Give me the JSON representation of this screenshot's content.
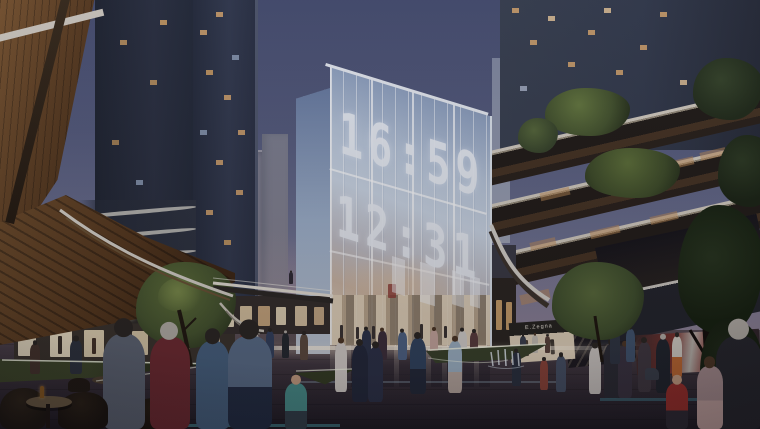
{
  "scene": {
    "title": "Dusk architectural rendering of a retail plaza with a glass clock building",
    "clock": {
      "row1": "16:59",
      "row2": "12:31"
    },
    "signs": {
      "swarovski": "Swarovski",
      "zegna": "E.Zegna",
      "givenchy": "Givenchy"
    },
    "palette": {
      "sky_top": "#464d6e",
      "sky_mid": "#6d7190",
      "horizon_pink": "#b99ba3",
      "glass_blue": "#aebfd6",
      "wood_brown": "#64452b",
      "plaza_dark": "#322b34",
      "digit_white": "#edf1f7",
      "tree_green": "#56663a",
      "window_warm": "#d9a868",
      "led_cyan": "#5ac8d2"
    }
  }
}
